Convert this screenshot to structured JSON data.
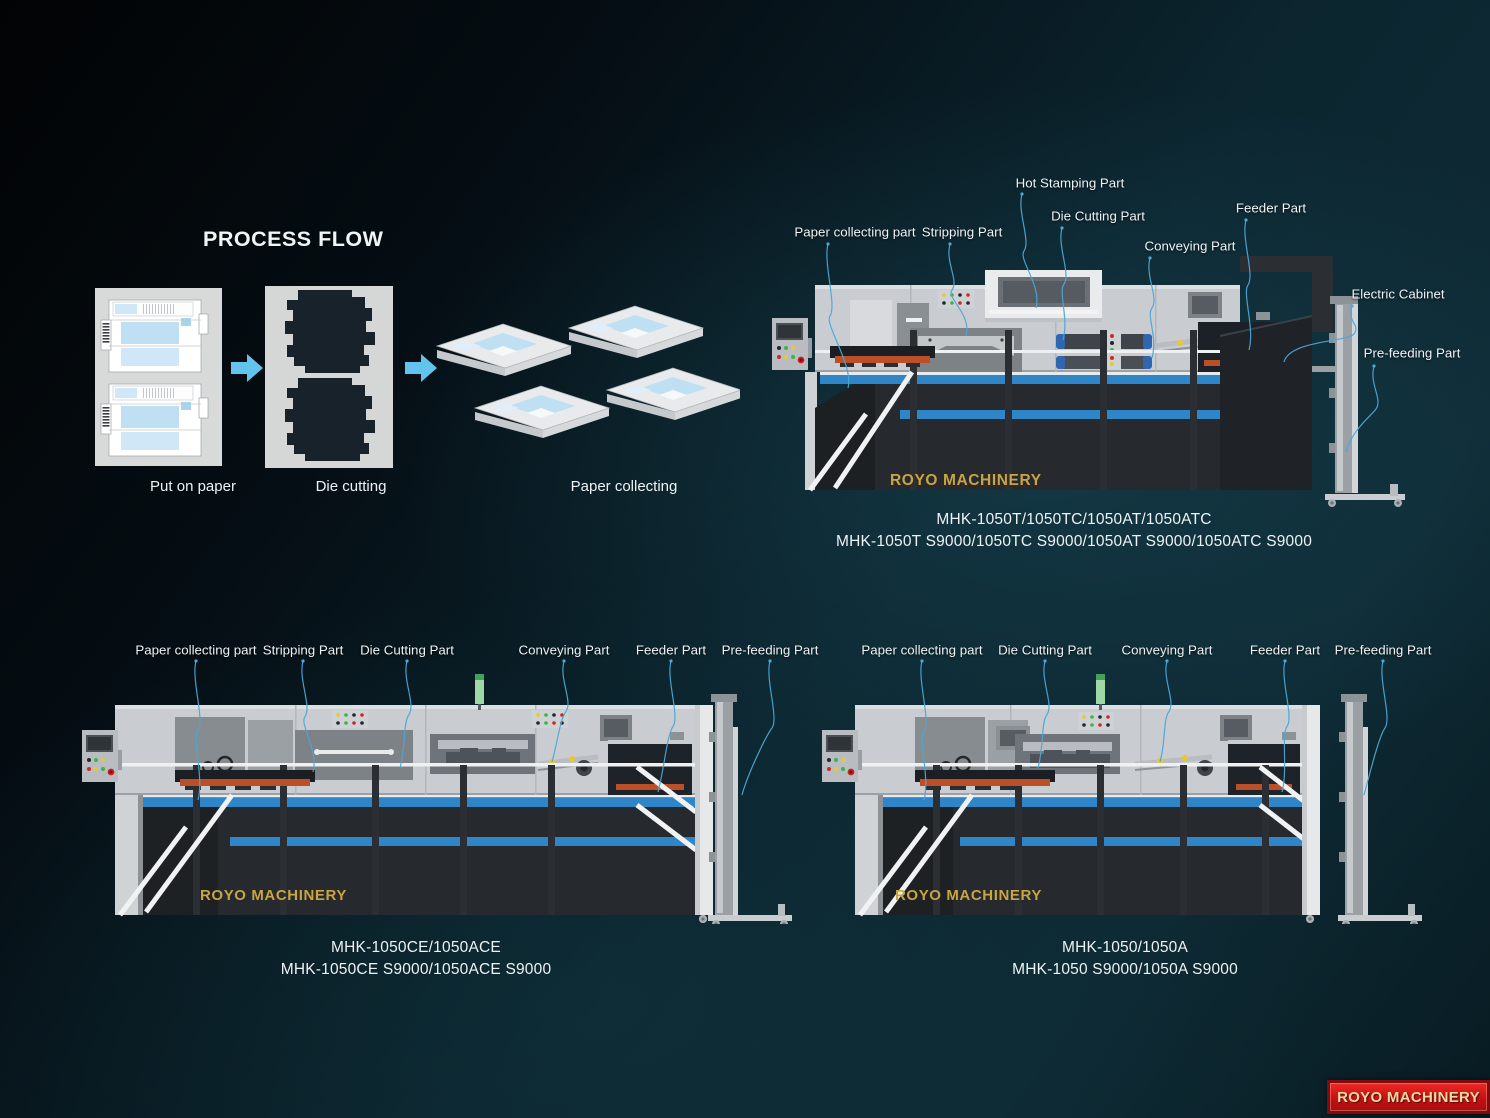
{
  "process_flow": {
    "title": "PROCESS FLOW",
    "steps": [
      "Put on paper",
      "Die cutting",
      "Paper collecting"
    ]
  },
  "machines": [
    {
      "brand_label": "ROYO MACHINERY",
      "part_labels": [
        "Paper collecting part",
        "Stripping Part",
        "Hot Stamping Part",
        "Die Cutting Part",
        "Conveying Part",
        "Feeder Part",
        "Electric Cabinet",
        "Pre-feeding Part"
      ],
      "model_line1": "MHK-1050T/1050TC/1050AT/1050ATC",
      "model_line2": "MHK-1050T S9000/1050TC S9000/1050AT S9000/1050ATC S9000"
    },
    {
      "brand_label": "ROYO MACHINERY",
      "part_labels": [
        "Paper collecting part",
        "Stripping Part",
        "Die Cutting Part",
        "Conveying Part",
        "Feeder Part",
        "Pre-feeding Part"
      ],
      "model_line1": "MHK-1050CE/1050ACE",
      "model_line2": "MHK-1050CE S9000/1050ACE S9000"
    },
    {
      "brand_label": "ROYO MACHINERY",
      "part_labels": [
        "Paper collecting part",
        "Die Cutting Part",
        "Conveying Part",
        "Feeder Part",
        "Pre-feeding Part"
      ],
      "model_line1": "MHK-1050/1050A",
      "model_line2": "MHK-1050 S9000/1050A S9000"
    }
  ],
  "footer_logo": {
    "text": "ROYO MACHINERY"
  },
  "colors": {
    "stripe_blue": "#2e86c8",
    "leader_blue": "#4ba7d7",
    "arrow_blue": "#62c3ec",
    "brand_gold": "#c9a440",
    "logo_red": "#c31215",
    "machine_body": "#c9cdd1",
    "machine_base": "#26292d",
    "orange_strip": "#bb5028",
    "background_teal": "#0c2630"
  }
}
